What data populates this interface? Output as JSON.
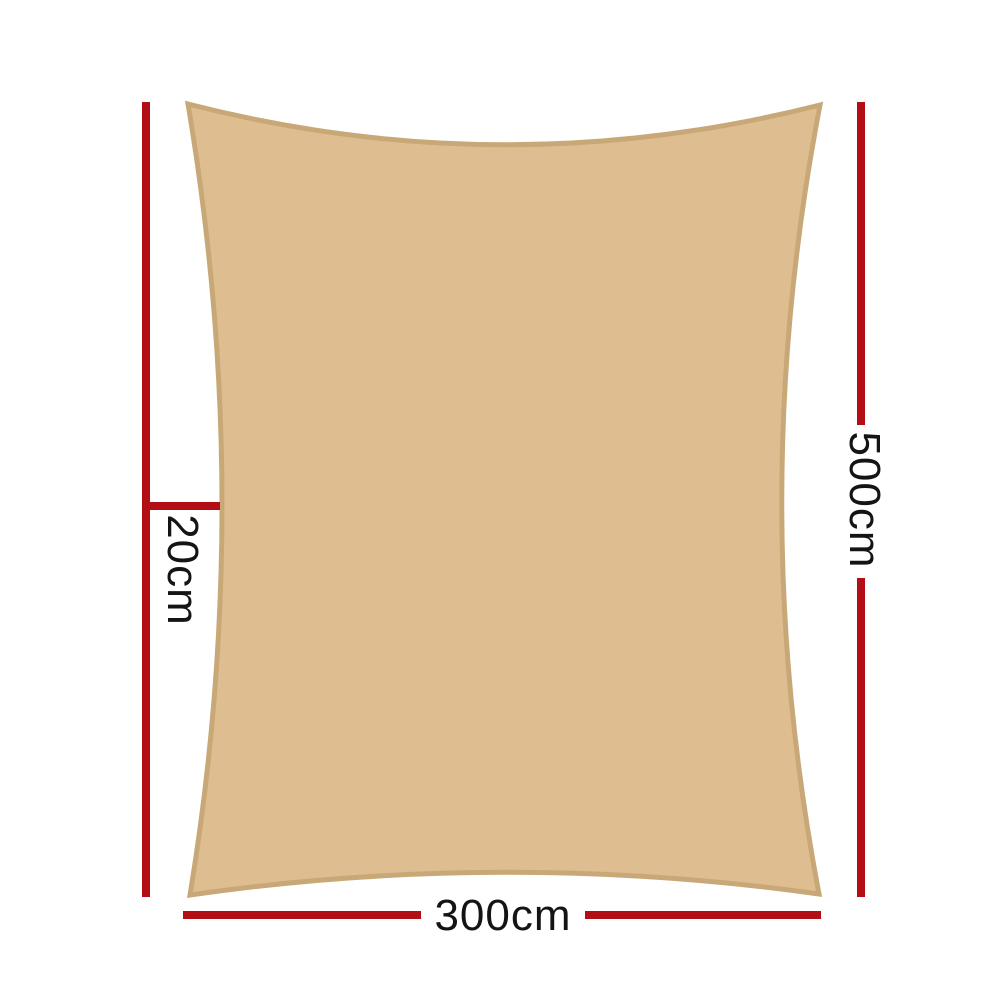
{
  "diagram": {
    "type": "product-dimension-diagram",
    "subject": "rectangle shade sail with concave edges",
    "labels": {
      "bottom_width": "300cm",
      "side_height": "500cm",
      "edge_curve_depth": "20cm"
    },
    "colors": {
      "sail_fill": "#DEBE90",
      "sail_border": "#C9A878",
      "dimension_line": "#B30E13",
      "text": "#141414",
      "background": "#FFFFFF"
    }
  }
}
